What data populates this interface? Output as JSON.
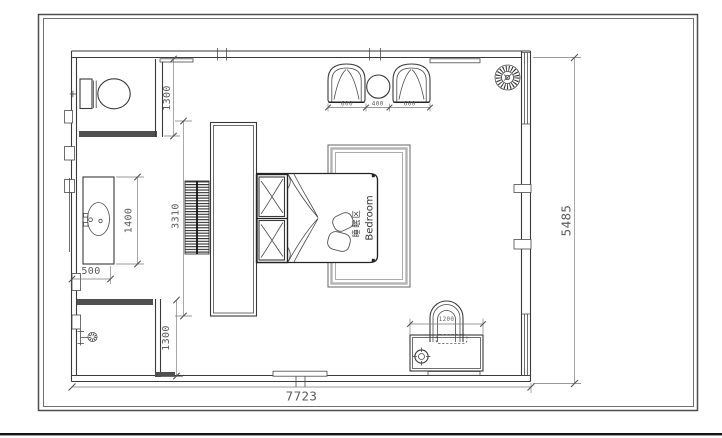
{
  "floorplan": {
    "labels": {
      "room_zh": "睡眠区",
      "room_en": "Bedroom"
    },
    "dims": {
      "overall_width": "7723",
      "overall_height": "5485",
      "toilet_room": "1300",
      "shower_room": "1300",
      "vanity_length": "1400",
      "vanity_width": "500",
      "tv_wall": "3310",
      "armchair_left": "600",
      "side_table": "400",
      "armchair_right": "600",
      "desk": "1200"
    }
  }
}
